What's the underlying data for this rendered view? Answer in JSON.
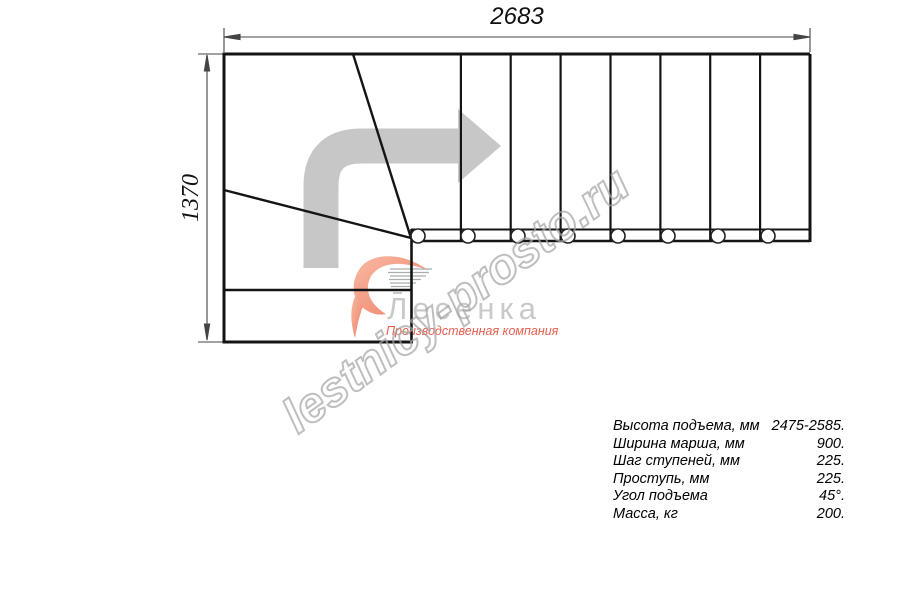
{
  "title": "Staircase plan technical drawing",
  "dimensions": {
    "width_mm": "2683",
    "height_mm": "1370"
  },
  "watermark": {
    "text": "lestnicy-prosto.ru"
  },
  "logo": {
    "name": "Лесенка",
    "tagline": "Производственная компания"
  },
  "specs": {
    "rows": [
      {
        "label": "Высота подъема, мм",
        "value": "2475-2585."
      },
      {
        "label": "Ширина марша, мм",
        "value": "900."
      },
      {
        "label": "Шаг ступеней, мм",
        "value": "225."
      },
      {
        "label": "Проступь, мм",
        "value": "225."
      },
      {
        "label": "Угол подъема",
        "value": "45°."
      },
      {
        "label": "Масса, кг",
        "value": "200."
      }
    ]
  },
  "drawing": {
    "straight_treads": 8,
    "winder_lines": 2,
    "baluster_circles": 8
  },
  "colors": {
    "line": "#141414",
    "dimension": "#444444",
    "arrow_gray": "#c7c7c7",
    "watermark_gray": "#a6a6a6",
    "logo_gray": "#c9c9c9",
    "logo_coral": "#f0876d",
    "tagline_red": "#e4604e"
  }
}
